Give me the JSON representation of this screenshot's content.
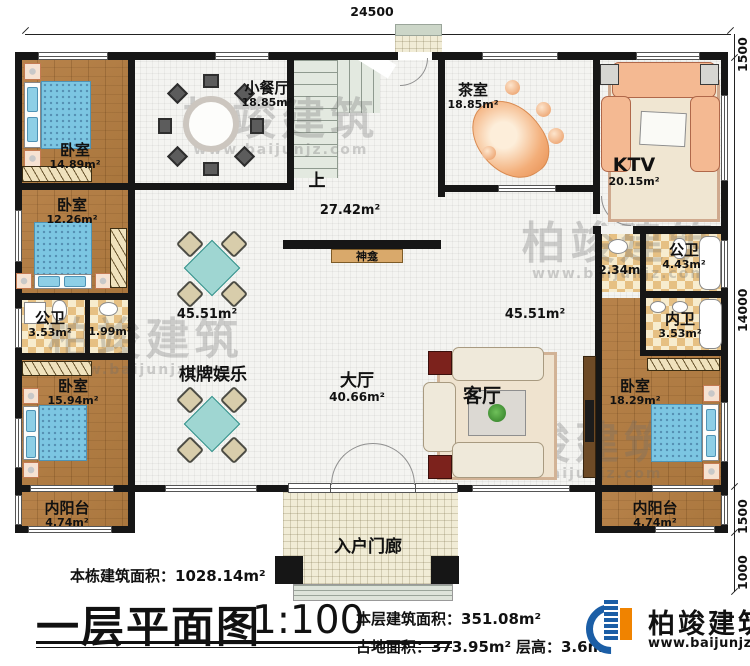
{
  "dimensions": {
    "top": "24500",
    "right_top": "1500",
    "right_main": "14000",
    "right_lower": "1500",
    "right_bottom": "1000"
  },
  "rooms": {
    "bedroom_tl": {
      "name": "卧室",
      "area": "14.89m²"
    },
    "bedroom_ml": {
      "name": "卧室",
      "area": "12.26m²"
    },
    "bath_left": {
      "name": "公卫",
      "area": "3.53m²"
    },
    "bath_left_vestibule": {
      "area": "1.99m²"
    },
    "bedroom_bl": {
      "name": "卧室",
      "area": "15.94m²"
    },
    "balcony_left": {
      "name": "内阳台",
      "area": "4.74m²"
    },
    "dining": {
      "name": "小餐厅",
      "area": "18.85m²"
    },
    "tea": {
      "name": "茶室",
      "area": "18.85m²"
    },
    "ktv": {
      "name": "KTV",
      "area": "20.15m²"
    },
    "stair_up": {
      "label": "上"
    },
    "shrine": {
      "name": "神龛"
    },
    "games": {
      "name": "棋牌娱乐"
    },
    "hall": {
      "name": "大厅",
      "area": "40.66m²"
    },
    "living": {
      "name": "客厅"
    },
    "bath_right": {
      "name": "公卫",
      "area": "4.43m²"
    },
    "bath_right_vestibule": {
      "area": "2.34m²"
    },
    "bath_inner": {
      "name": "内卫",
      "area": "3.53m²"
    },
    "bedroom_r": {
      "name": "卧室",
      "area": "18.29m²"
    },
    "balcony_right": {
      "name": "内阳台",
      "area": "4.74m²"
    },
    "porch": {
      "name": "入户门廊"
    }
  },
  "open_areas": {
    "upper": "27.42m²",
    "left": "45.51m²",
    "right": "45.51m²"
  },
  "footer": {
    "building_total": "本栋建筑面积：1028.14m²",
    "title": "一层平面图",
    "scale": "1:100",
    "floor_area": "本层建筑面积：351.08m²",
    "site_area": "占地面积：373.95m²",
    "floor_height": "层高：3.6m"
  },
  "logo": {
    "name": "柏竣建筑",
    "url": "www.baijunjz.com"
  },
  "watermark": {
    "text": "柏竣建筑",
    "url": "www.baijunjz.com"
  }
}
